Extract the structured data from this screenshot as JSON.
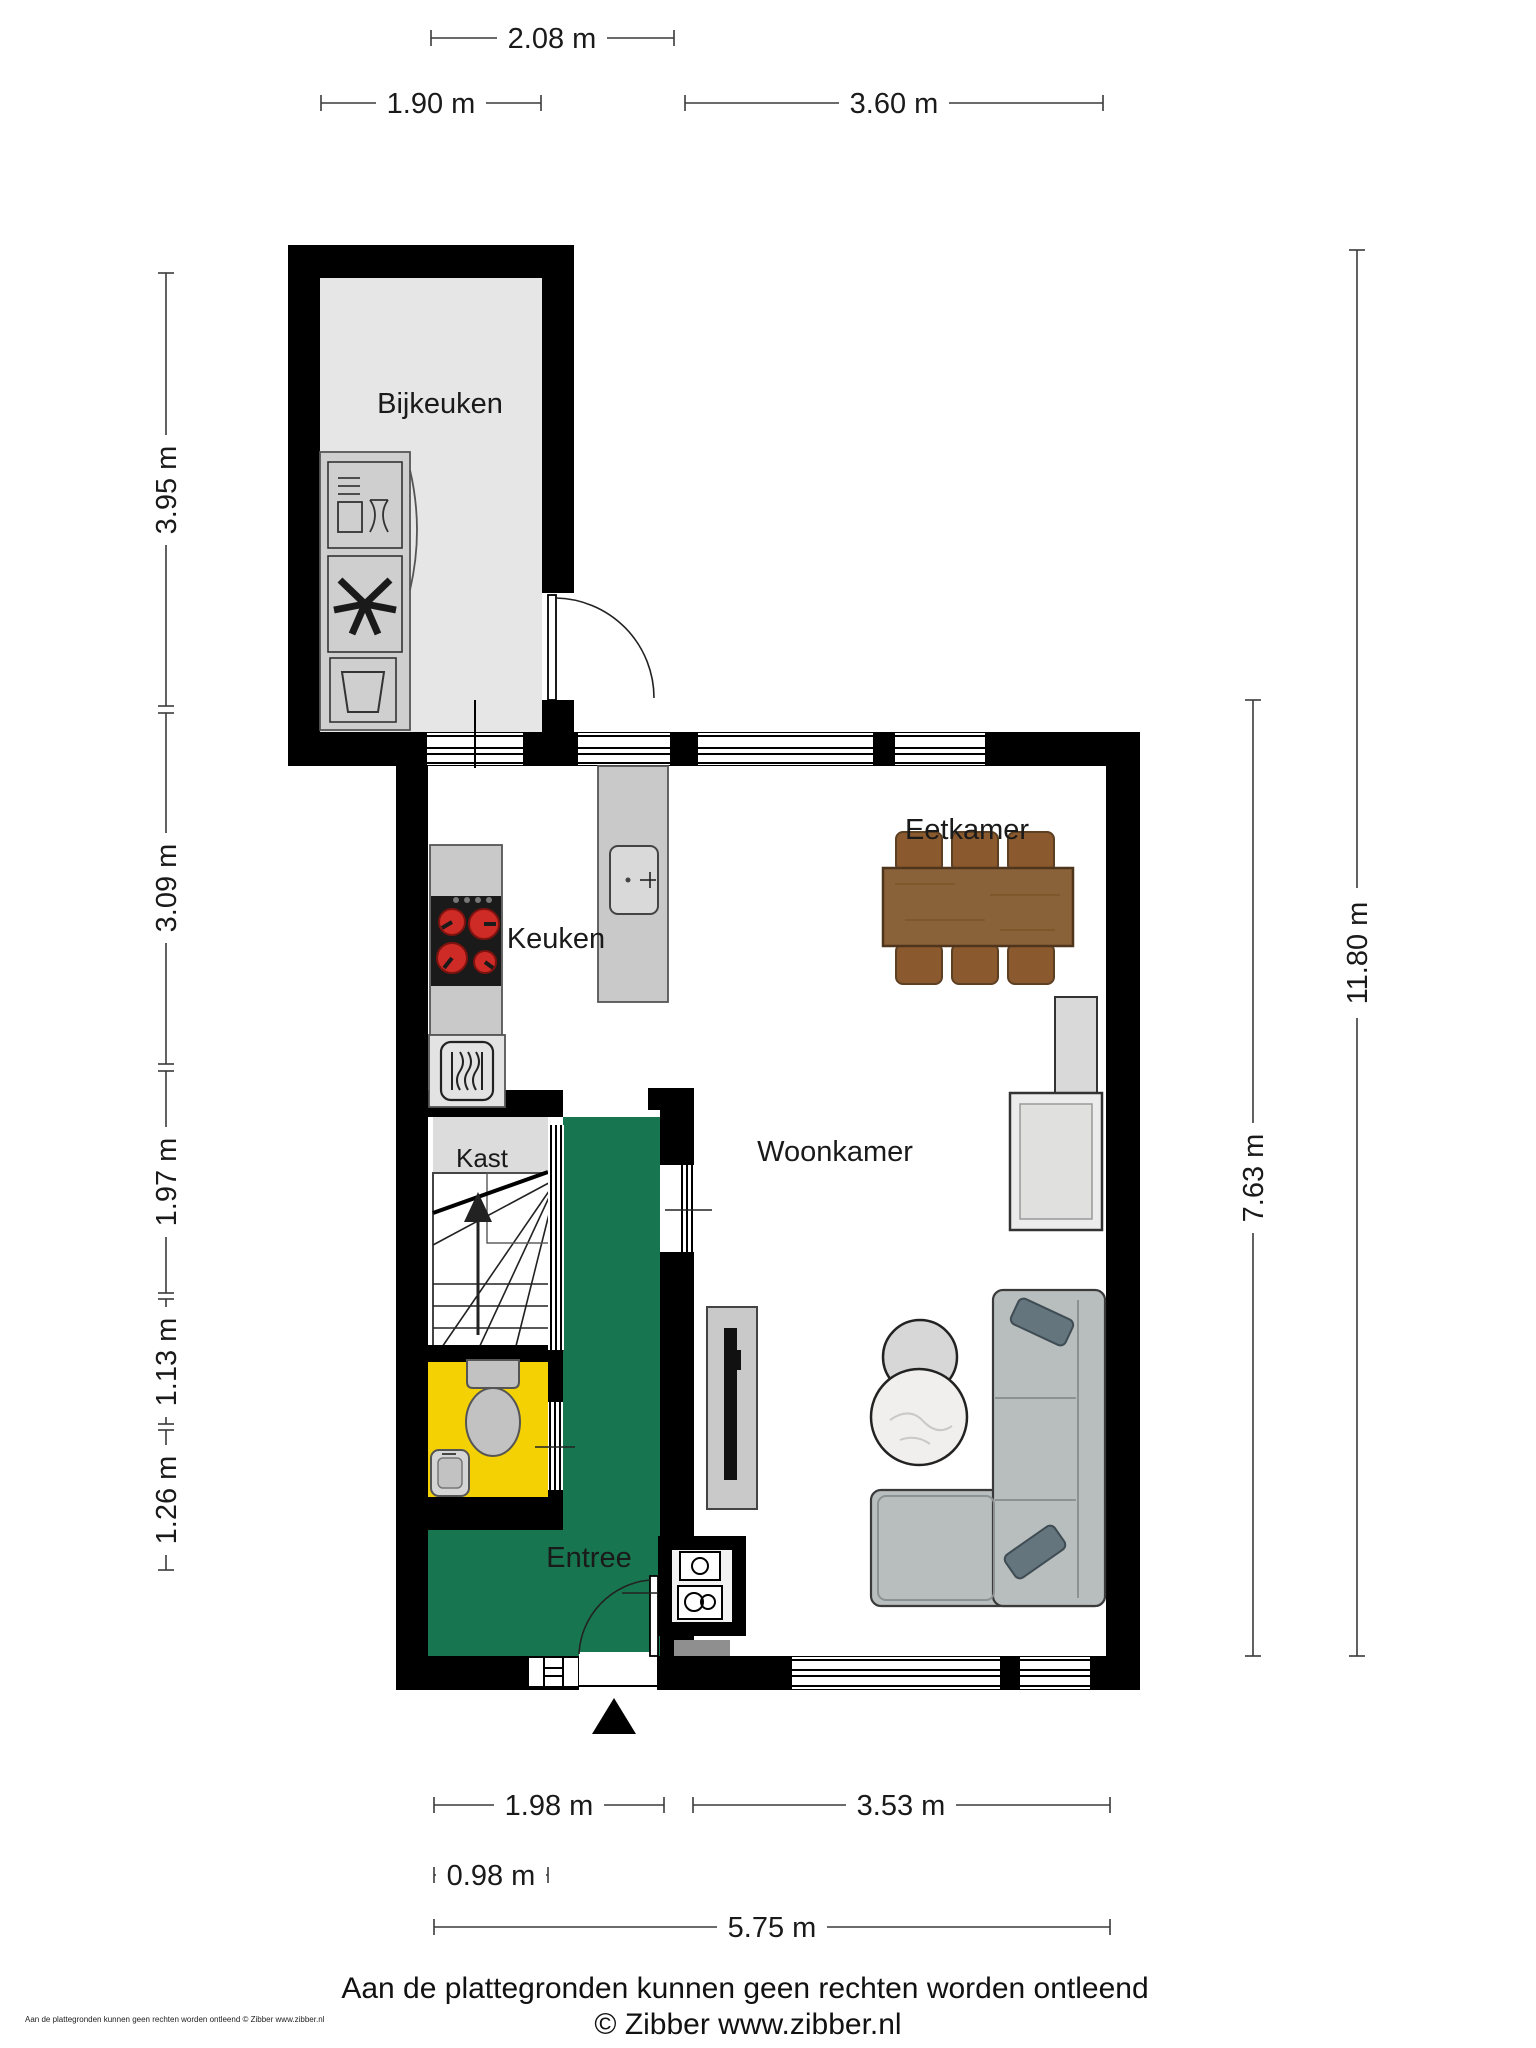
{
  "rooms": {
    "bijkeuken": "Bijkeuken",
    "keuken": "Keuken",
    "eetkamer": "Eetkamer",
    "woonkamer": "Woonkamer",
    "kast": "Kast",
    "entree": "Entree"
  },
  "dimensions": {
    "top": {
      "d208": "2.08 m",
      "d190": "1.90 m",
      "d360": "3.60 m"
    },
    "left": {
      "d395": "3.95 m",
      "d309": "3.09 m",
      "d197": "1.97 m",
      "d113": "1.13 m",
      "d126": "1.26 m"
    },
    "right": {
      "d763": "7.63 m",
      "d1180": "11.80 m"
    },
    "bottom": {
      "d198": "1.98 m",
      "d353": "3.53 m",
      "d098": "0.98 m",
      "d575": "5.75 m"
    }
  },
  "footer": {
    "disclaimer": "Aan de plattegronden kunnen geen rechten worden ontleend",
    "copyright": "© Zibber www.zibber.nl",
    "micro": "Aan de plattegronden kunnen geen rechten worden ontleend © Zibber www.zibber.nl"
  },
  "colors": {
    "wall": "#000000",
    "bijkeuken_floor": "#e6e6e6",
    "kast_floor": "#dcdcdc",
    "entree_floor": "#17764f",
    "toilet_floor": "#f3d103",
    "counter": "#c9c9c9",
    "cooktop": "#1a1a1a",
    "burner": "#cf2b26",
    "table_wood": "#8a6239",
    "chair_wood": "#8a5a2e",
    "sofa": "#b8bebd",
    "pillow": "#64757e",
    "fixture": "#c2c2c2",
    "fireplace": "#ececec",
    "tv": "#111111"
  }
}
